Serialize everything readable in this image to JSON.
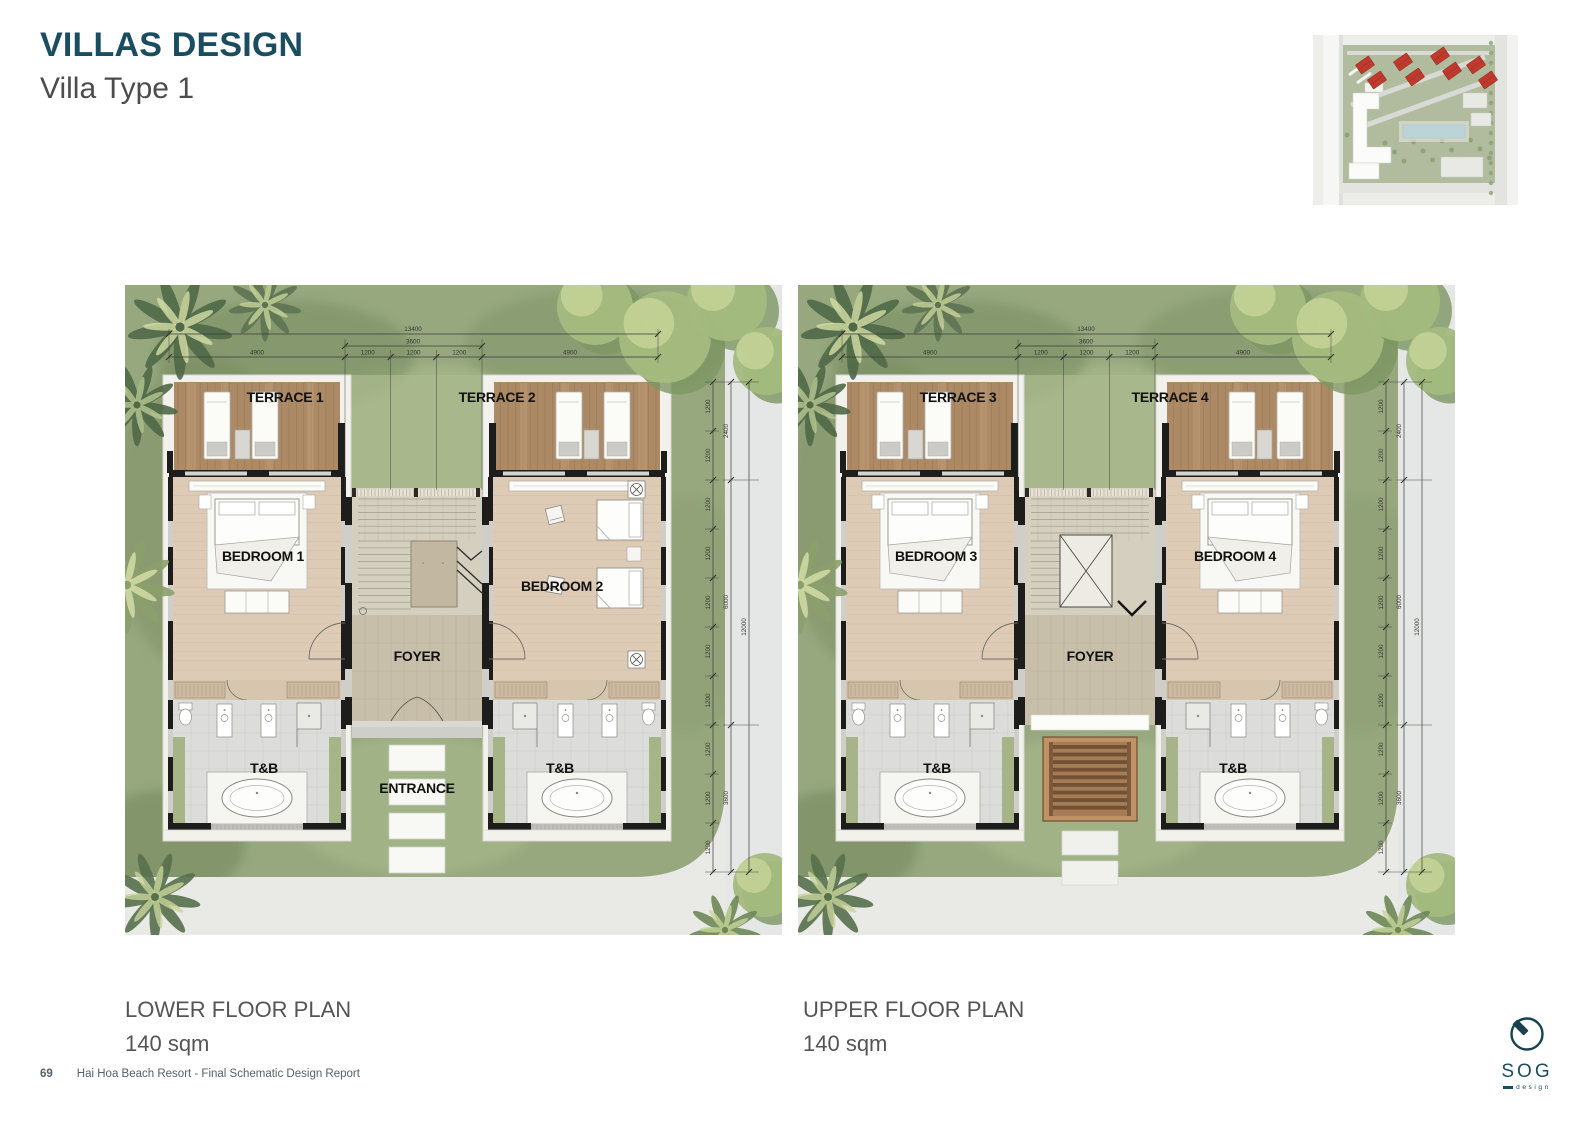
{
  "header": {
    "title": "VILLAS DESIGN",
    "subtitle": "Villa Type 1"
  },
  "plans": [
    {
      "caption": "LOWER FLOOR PLAN",
      "area": "140 sqm",
      "variant": "lower",
      "rooms": {
        "terrace_left": "TERRACE 1",
        "terrace_right": "TERRACE 2",
        "bedroom_left": "BEDROOM 1",
        "bedroom_right": "BEDROOM 2",
        "foyer": "FOYER",
        "tb_left": "T&B",
        "tb_right": "T&B",
        "entrance": "ENTRANCE"
      }
    },
    {
      "caption": "UPPER FLOOR PLAN",
      "area": "140 sqm",
      "variant": "upper",
      "rooms": {
        "terrace_left": "TERRACE 3",
        "terrace_right": "TERRACE 4",
        "bedroom_left": "BEDROOM 3",
        "bedroom_right": "BEDROOM 4",
        "foyer": "FOYER",
        "tb_left": "T&B",
        "tb_right": "T&B"
      }
    }
  ],
  "dimensions": {
    "top_total": "13400",
    "top_mid": "3600",
    "top_row": [
      "4900",
      "1200",
      "1200",
      "1200",
      "4900"
    ],
    "right_inner": [
      "1200",
      "1200",
      "1200",
      "1200",
      "1200",
      "1200",
      "1200",
      "1200",
      "1200",
      "1200"
    ],
    "right_mid": [
      "2400",
      "6000",
      "3600"
    ],
    "right_outer": "12000"
  },
  "footer": {
    "page_number": "69",
    "report_title": "Hai Hoa Beach Resort - Final Schematic Design Report"
  },
  "logo": {
    "name": "SOG",
    "subtitle": "design"
  },
  "colors": {
    "accent_teal": "#1b4d61",
    "villa_highlight_red": "#bf3a2c"
  }
}
